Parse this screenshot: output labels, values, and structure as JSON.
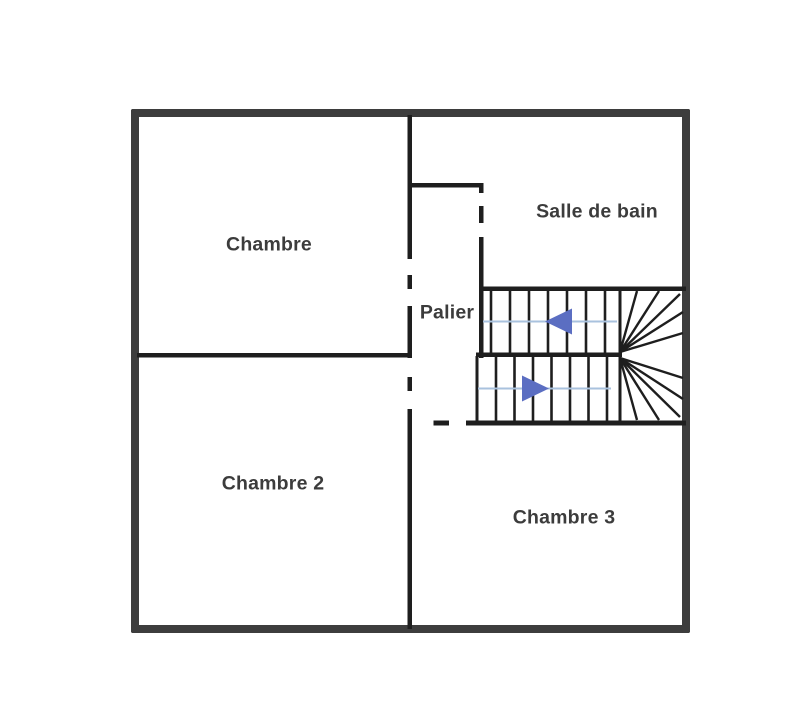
{
  "plan": {
    "kind_label": "first-floor-plan"
  },
  "rooms": [
    {
      "id": "chambre",
      "label": "Chambre"
    },
    {
      "id": "salle-de-bain",
      "label": "Salle de bain"
    },
    {
      "id": "palier",
      "label": "Palier"
    },
    {
      "id": "chambre-2",
      "label": "Chambre 2"
    },
    {
      "id": "chambre-3",
      "label": "Chambre 3"
    }
  ],
  "stairs": {
    "upper_flight_arrow_direction": "left",
    "lower_flight_arrow_direction": "right",
    "arrow_color": "#5b6ec2",
    "guide_line_color": "#a9c2de"
  },
  "colors": {
    "outer_wall": "#3d3d3d",
    "interior_wall": "#1e1e1e",
    "label_text": "#3c3c3c",
    "background": "#ffffff"
  }
}
